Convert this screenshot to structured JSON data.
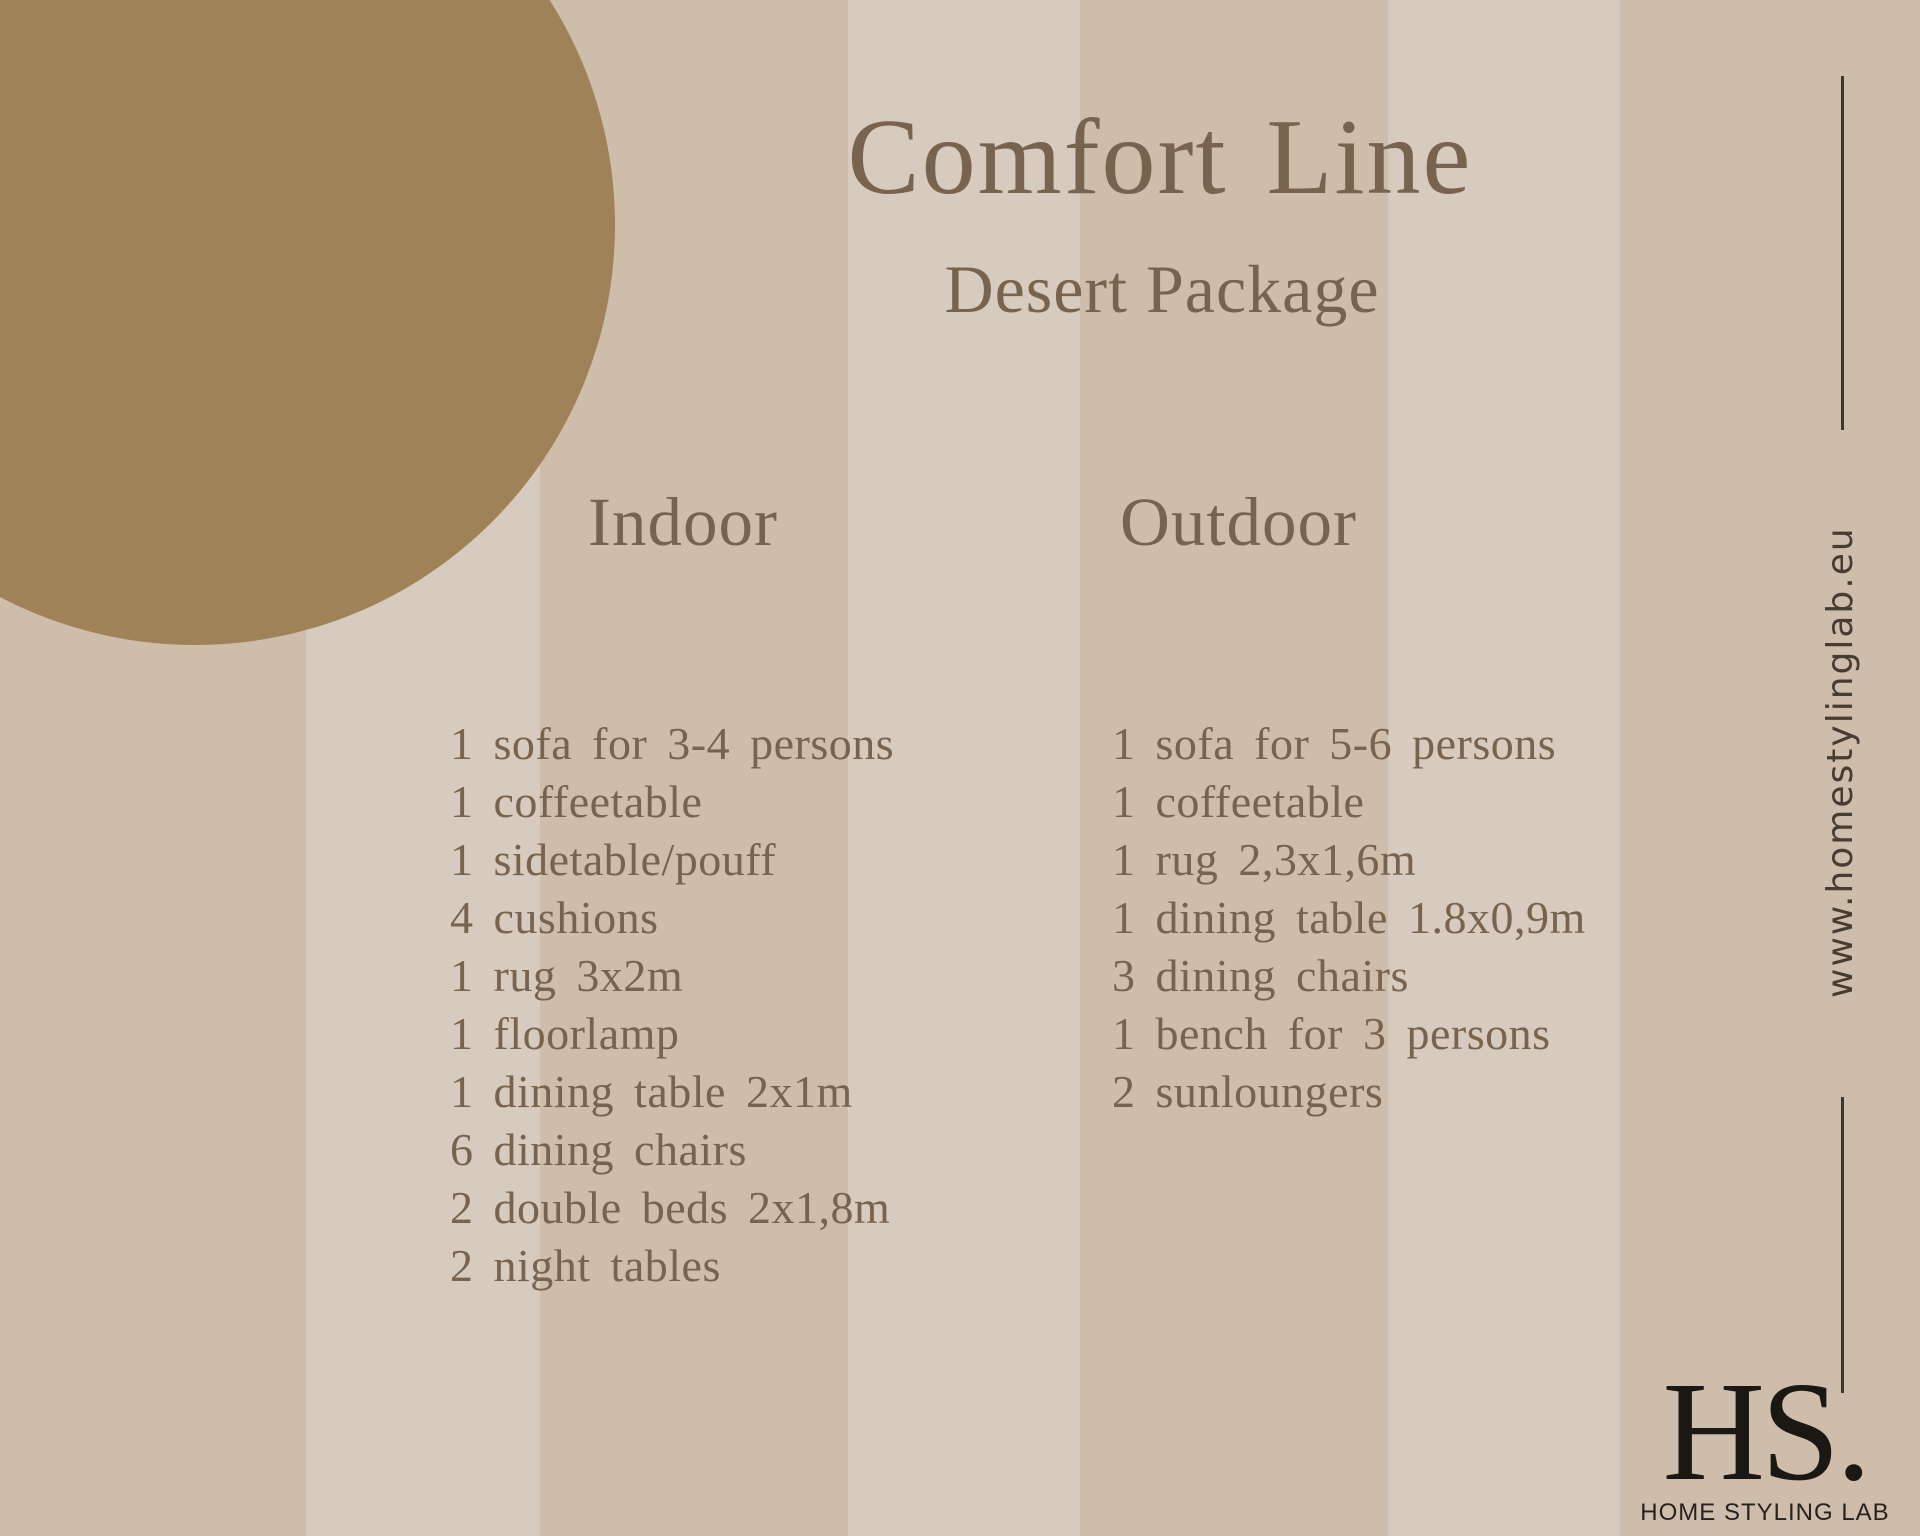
{
  "title": "Comfort Line",
  "subtitle": "Desert Package",
  "columns": [
    {
      "heading": "Indoor",
      "items": [
        "1 sofa for 3-4 persons",
        "1 coffeetable",
        "1 sidetable/pouff",
        "4 cushions",
        "1 rug 3x2m",
        "1 floorlamp",
        "1 dining table 2x1m",
        "6 dining chairs",
        "2 double beds 2x1,8m",
        "2 night tables"
      ]
    },
    {
      "heading": "Outdoor",
      "items": [
        "1 sofa for 5-6 persons",
        "1 coffeetable",
        "1 rug 2,3x1,6m",
        "1 dining table 1.8x0,9m",
        "3 dining chairs",
        "1 bench for 3 persons",
        "2 sunloungers"
      ]
    }
  ],
  "sidebar": {
    "website": "www.homestylinglab.eu"
  },
  "logo": {
    "monogram": "HS.",
    "name": "HOME STYLING LAB"
  },
  "colors": {
    "stripe_dark": "#cebdab",
    "stripe_light": "#d6cbbe",
    "circle": "#9f8258",
    "text_brown": "#77634e",
    "text_dark": "#463c32",
    "logo_black": "#1b1814"
  }
}
